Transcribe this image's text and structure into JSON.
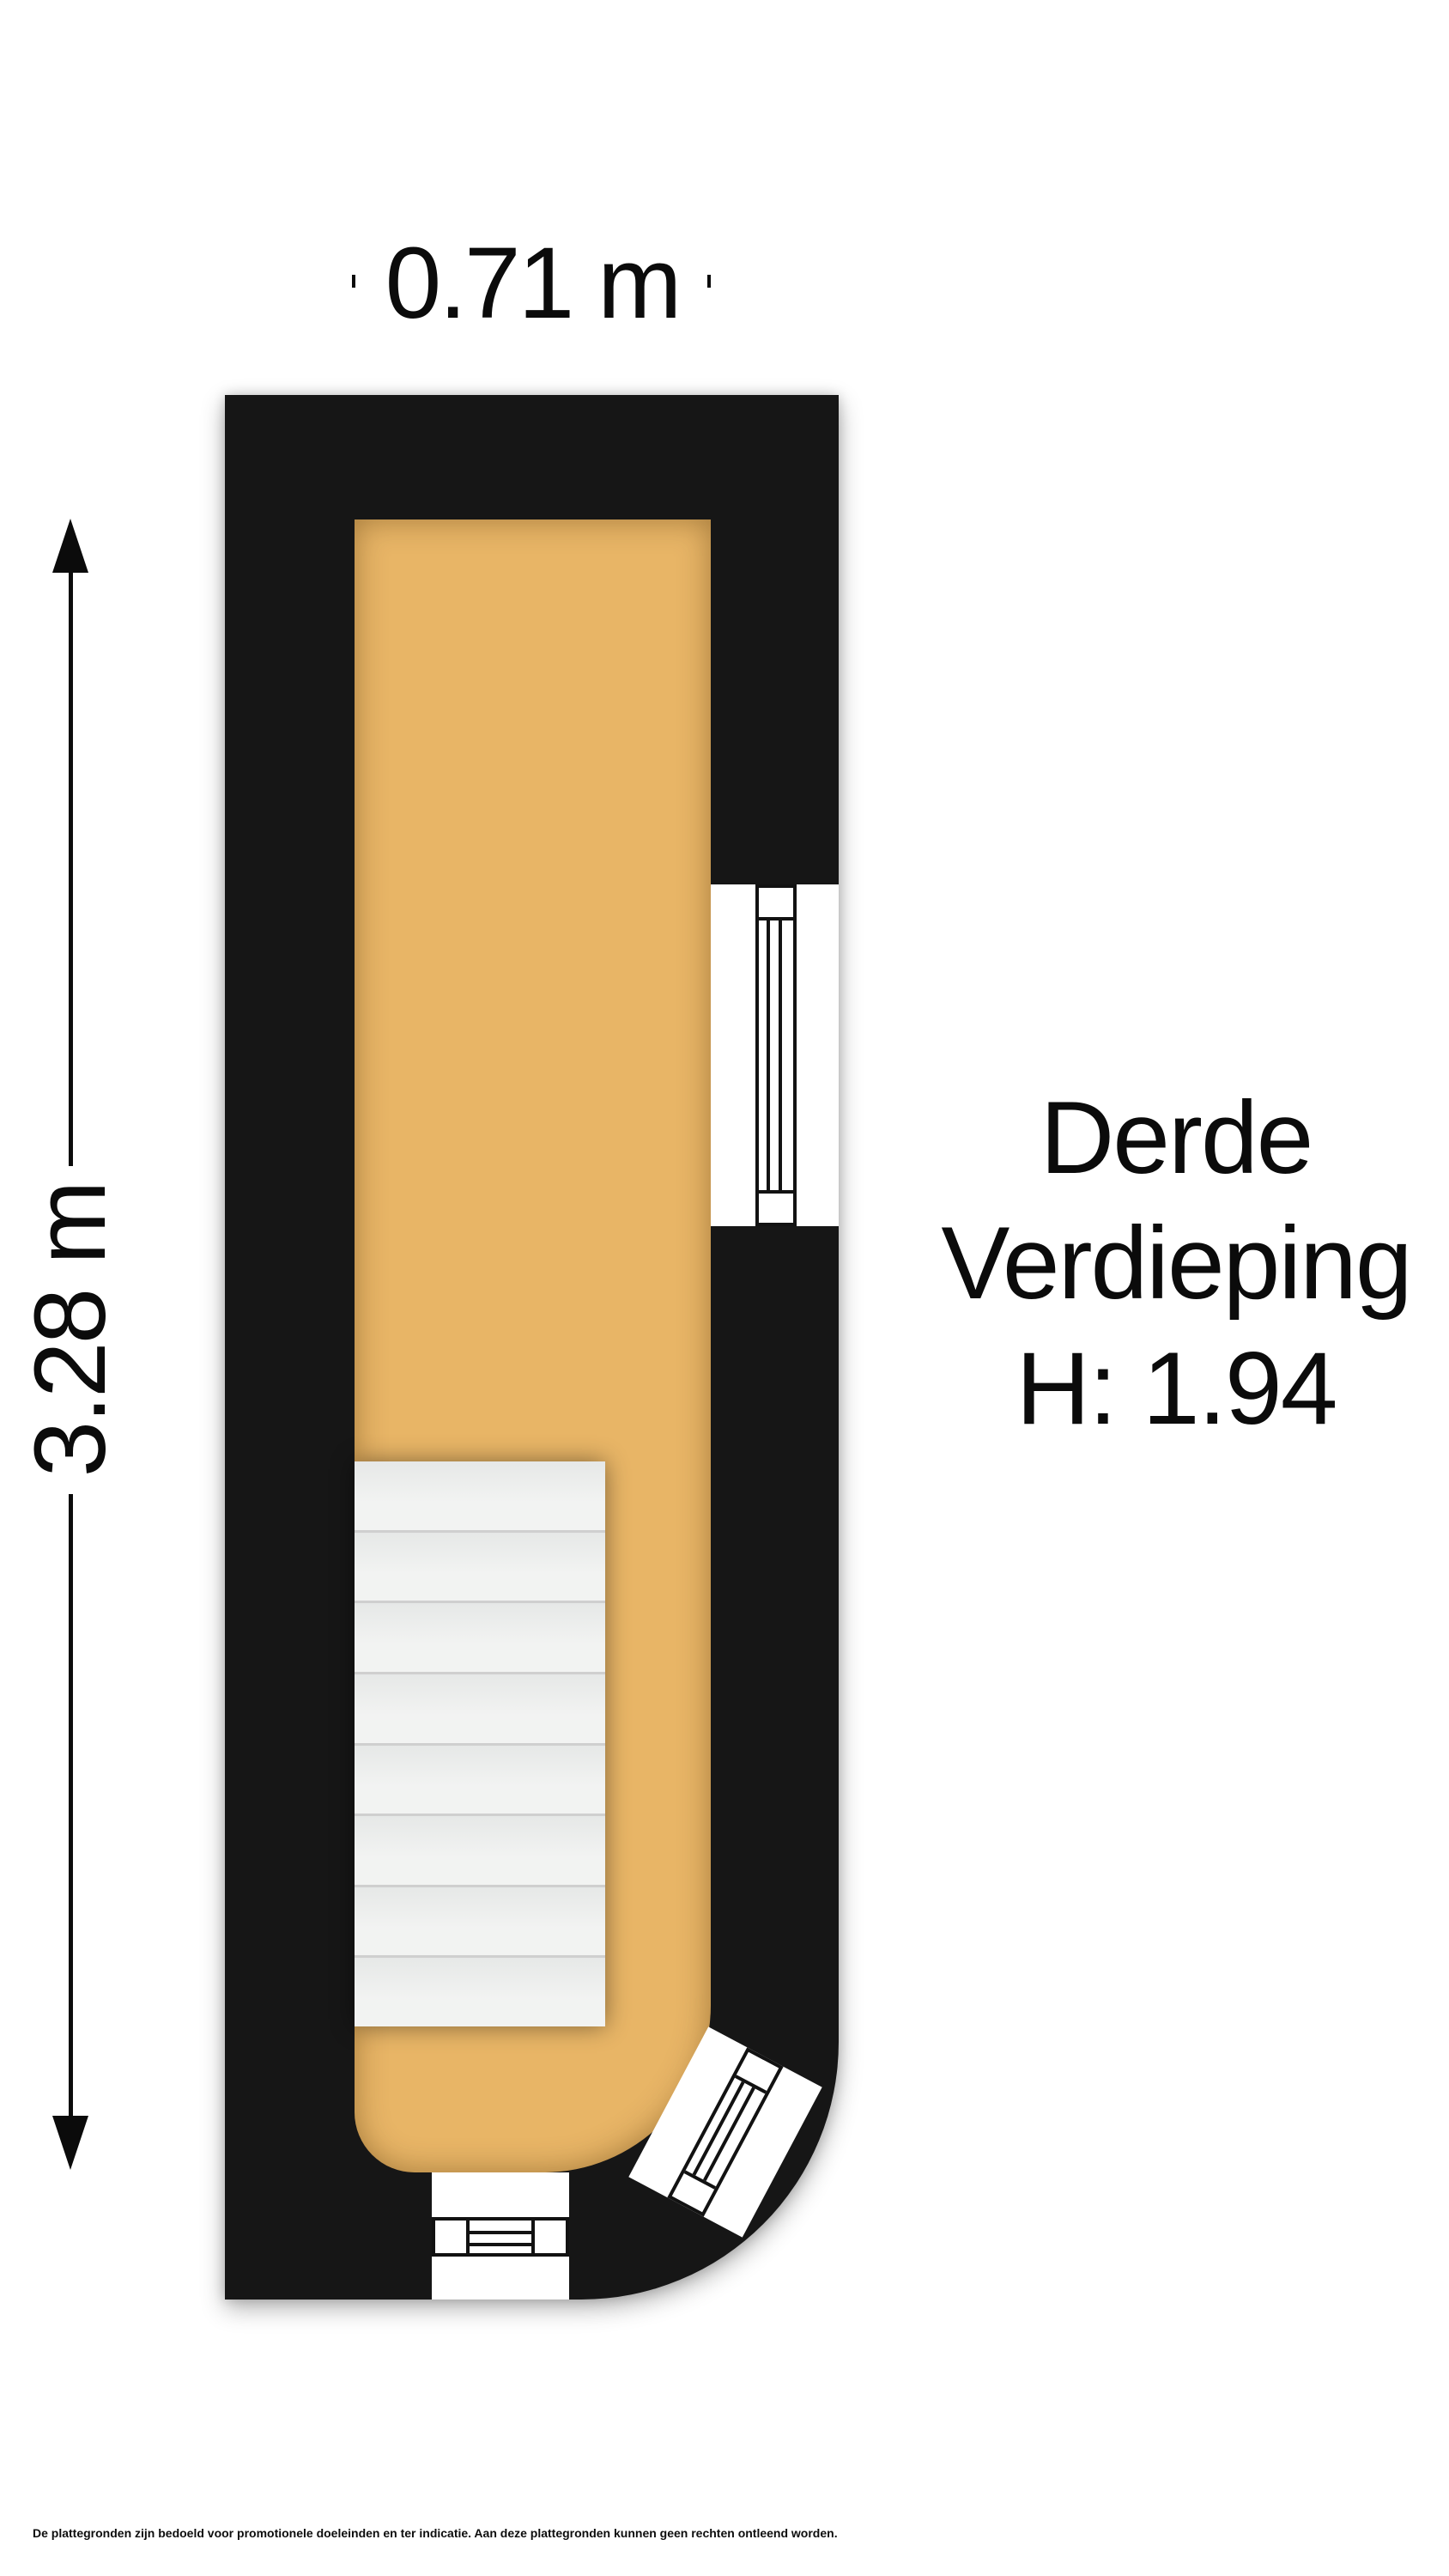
{
  "dimensions": {
    "width_label": "0.71 m",
    "height_label": "3.28 m"
  },
  "floor_label": {
    "line1": "Derde",
    "line2": "Verdieping",
    "line3": "H: 1.94"
  },
  "disclaimer": "De plattegronden zijn bedoeld voor promotionele doeleinden en ter indicatie. Aan deze plattegronden kunnen geen rechten ontleend worden.",
  "stairs": {
    "step_count": 8
  },
  "colors": {
    "wall": "#161616",
    "floor": "#e8b566",
    "stairs": "#eef0ef",
    "stair-line": "#cfcfcf",
    "ink": "#0b0b0b",
    "page": "#ffffff"
  }
}
